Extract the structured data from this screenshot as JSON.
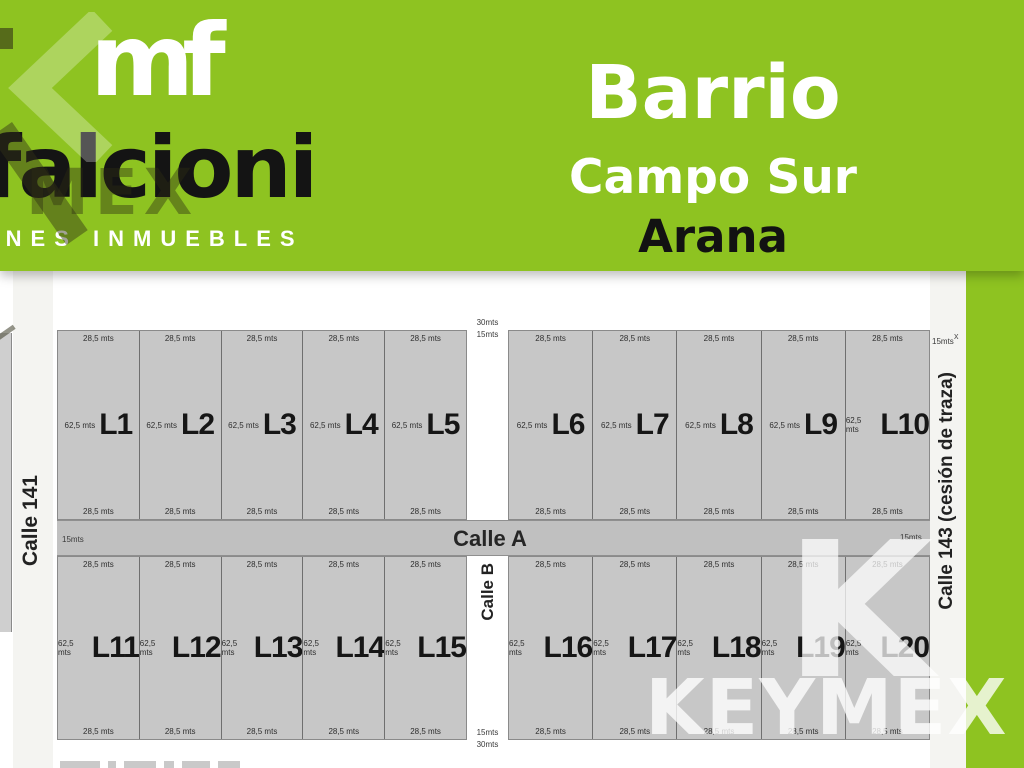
{
  "header": {
    "logo": {
      "monogram": "mf",
      "brand": "falcioni",
      "tagline": "BIENES INMUEBLES"
    },
    "title": {
      "line1": "Barrio",
      "line2": "Campo Sur",
      "line3": "Arana"
    }
  },
  "map": {
    "streets": {
      "left": "Calle 141",
      "right": "Calle 143 (cesión de traza)",
      "horizontal": "Calle A",
      "vertical": "Calle B"
    },
    "width_labels": {
      "calle_a_left": "15mts",
      "calle_a_right": "15mts",
      "calle_143_top": "15mts",
      "calle_143_mark": "x",
      "gap_top": [
        "30mts",
        "15mts"
      ],
      "gap_bottom": [
        "15mts",
        "30mts"
      ]
    },
    "lot_defaults": {
      "front": "28,5 mts",
      "depth": "62,5 mts"
    },
    "blocks": [
      {
        "id": "top-left",
        "lots": [
          "L1",
          "L2",
          "L3",
          "L4",
          "L5"
        ]
      },
      {
        "id": "top-right",
        "lots": [
          "L6",
          "L7",
          "L8",
          "L9",
          "L10"
        ]
      },
      {
        "id": "bottom-left",
        "lots": [
          "L11",
          "L12",
          "L13",
          "L14",
          "L15"
        ]
      },
      {
        "id": "bottom-right",
        "lots": [
          "L16",
          "L17",
          "L18",
          "L19",
          "L20"
        ]
      }
    ]
  },
  "watermark": {
    "brand": "KEYMEX",
    "big_letter": "K",
    "partial_text": "MEX"
  },
  "colors": {
    "brand_green": "#8EC321",
    "lot_gray": "#C7C7C7",
    "street_band_gray": "#C0C0C0",
    "strip_offwhite": "#F4F4F1",
    "text_dark": "#161616"
  }
}
